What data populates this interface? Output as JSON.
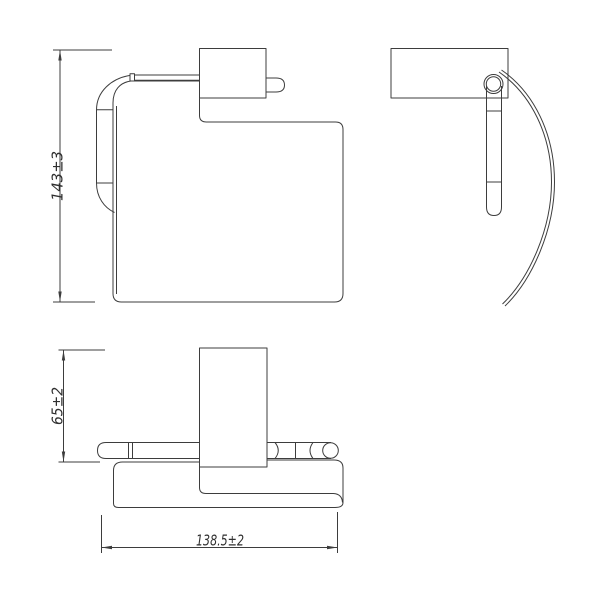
{
  "document": {
    "kind": "technical-drawing",
    "subject": "wall-mounted toilet paper holder with cover, three orthographic views",
    "background_color": "#ffffff",
    "line_color": "#3d3d3d",
    "text_color": "#2f2f2f"
  },
  "dimensions": {
    "height": "143±3",
    "depth": "65±2",
    "width": "138.5±2"
  }
}
